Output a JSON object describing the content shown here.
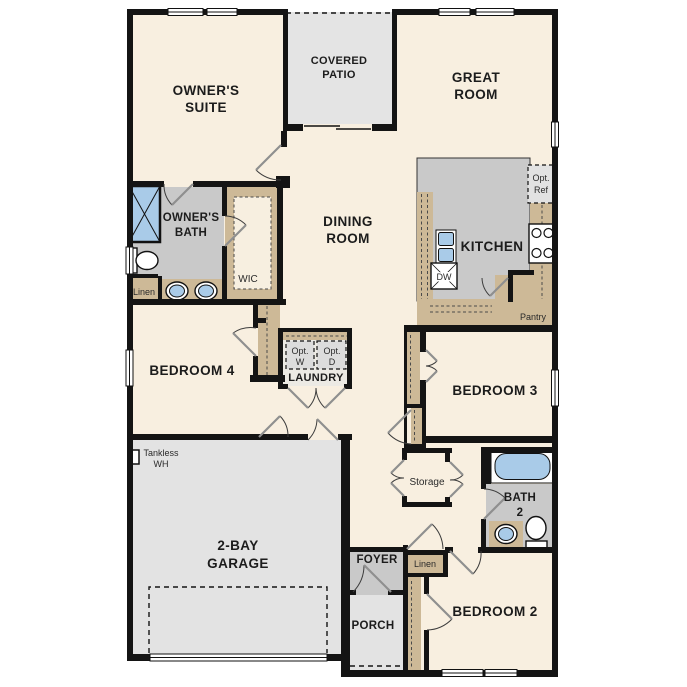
{
  "plan": {
    "title": "single-story-floor-plan",
    "colors": {
      "floor_cream": "#f8efe0",
      "patio_gray": "#e4e4e4",
      "garage_gray": "#e3e3e3",
      "bath_gray": "#c9c9c9",
      "foyer_gray": "#c9c9c9",
      "cabinet_tan": "#cdb997",
      "fixture_blue": "#a9cbe8",
      "wall_black": "#141414",
      "option_box_gray": "#dcdcdc"
    },
    "rooms": {
      "owners_suite": {
        "line1": "OWNER'S",
        "line2": "SUITE"
      },
      "covered_patio": {
        "line1": "COVERED",
        "line2": "PATIO"
      },
      "great_room": {
        "line1": "GREAT",
        "line2": "ROOM"
      },
      "dining_room": {
        "line1": "DINING",
        "line2": "ROOM"
      },
      "kitchen": {
        "label": "KITCHEN"
      },
      "owners_bath": {
        "line1": "OWNER'S",
        "line2": "BATH"
      },
      "wic": {
        "label": "WIC"
      },
      "linen_owners": {
        "label": "Linen"
      },
      "bedroom4": {
        "label": "BEDROOM 4"
      },
      "laundry": {
        "label": "LAUNDRY"
      },
      "opt_washer": {
        "line1": "Opt.",
        "line2": "W"
      },
      "opt_dryer": {
        "line1": "Opt.",
        "line2": "D"
      },
      "opt_ref": {
        "line1": "Opt.",
        "line2": "Ref"
      },
      "dishwasher": {
        "label": "DW"
      },
      "pantry": {
        "label": "Pantry"
      },
      "tankless_wh": {
        "line1": "Tankless",
        "line2": "WH"
      },
      "garage": {
        "line1": "2-BAY",
        "line2": "GARAGE"
      },
      "storage": {
        "label": "Storage"
      },
      "bath2": {
        "line1": "BATH",
        "line2": "2"
      },
      "foyer": {
        "label": "FOYER"
      },
      "linen_hall": {
        "label": "Linen"
      },
      "porch": {
        "label": "PORCH"
      },
      "bedroom3": {
        "label": "BEDROOM 3"
      },
      "bedroom2": {
        "label": "BEDROOM 2"
      }
    }
  }
}
